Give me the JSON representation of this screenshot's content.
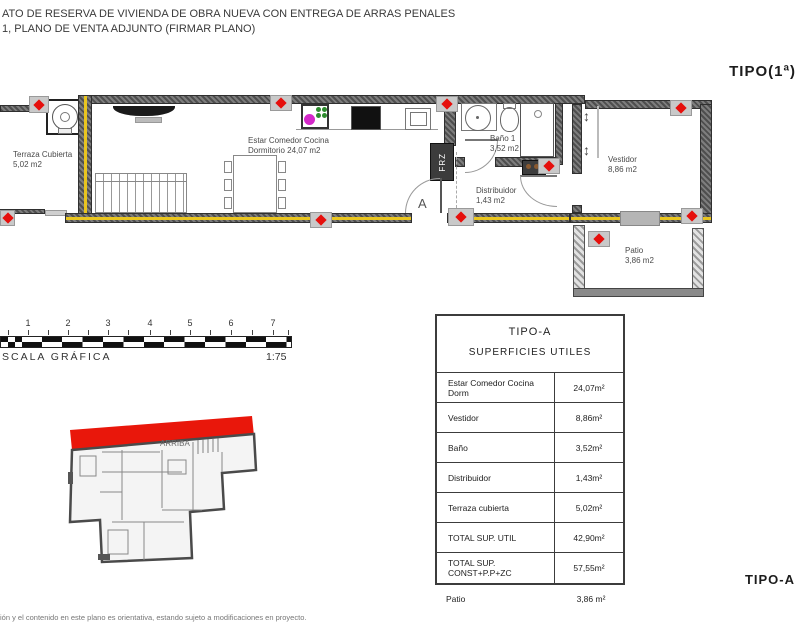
{
  "colors": {
    "marker_red": "#e60f0c",
    "wall_dark": "#4e4e4e",
    "insulation_yellow": "#e9c51f",
    "keyplan_red": "#e9170b"
  },
  "header": {
    "line1": "ATO DE RESERVA DE VIVIENDA DE OBRA NUEVA CON ENTREGA DE ARRAS PENALES",
    "line2": "1, PLANO DE VENTA ADJUNTO (FIRMAR PLANO)"
  },
  "type_label_top": "TIPO(1ª)",
  "type_label_bottom": "TIPO-A",
  "floorplan": {
    "terraza": {
      "line1": "Terraza Cubierta",
      "line2": "5,02 m2"
    },
    "estar": {
      "line1": "Estar Comedor Cocina",
      "line2": "Dormitorio 24,07 m2"
    },
    "bano": {
      "line1": "Baño 1",
      "line2": "3,52 m2"
    },
    "distribuidor": {
      "line1": "Distribuidor",
      "line2": "1,43 m2"
    },
    "vestidor": {
      "line1": "Vestidor",
      "line2": "8,86 m2"
    },
    "patio": {
      "line1": "Patio",
      "line2": "3,86 m2"
    },
    "door_label": "A",
    "fridge_label": "FRZ",
    "closet_arrow": "↕"
  },
  "scalebar": {
    "ticks": [
      "1",
      "2",
      "3",
      "4",
      "5",
      "6",
      "7"
    ],
    "label": "SCALA GRÁFICA",
    "ratio": "1:75"
  },
  "keyplan": {
    "stairs_label": "ARRIBA"
  },
  "table": {
    "title": "TIPO-A",
    "subtitle": "SUPERFICIES UTILES",
    "rows": [
      {
        "label": "Estar Comedor Cocina Dorm",
        "value": "24,07m²"
      },
      {
        "label": "Vestidor",
        "value": "8,86m²"
      },
      {
        "label": "Baño",
        "value": "3,52m²"
      },
      {
        "label": "Distribuidor",
        "value": "1,43m²"
      },
      {
        "label": "Terraza cubierta",
        "value": "5,02m²"
      },
      {
        "label": "TOTAL SUP. UTIL",
        "value": "42,90m²"
      },
      {
        "label": "TOTAL SUP. CONST+P.P+ZC",
        "value": "57,55m²"
      }
    ],
    "patio_row": {
      "label": "Patio",
      "value": "3,86 m²"
    }
  },
  "footer": {
    "disclaimer": "ión y el contenido en este plano es orientativa, estando sujeto a modificaciones en proyecto."
  }
}
